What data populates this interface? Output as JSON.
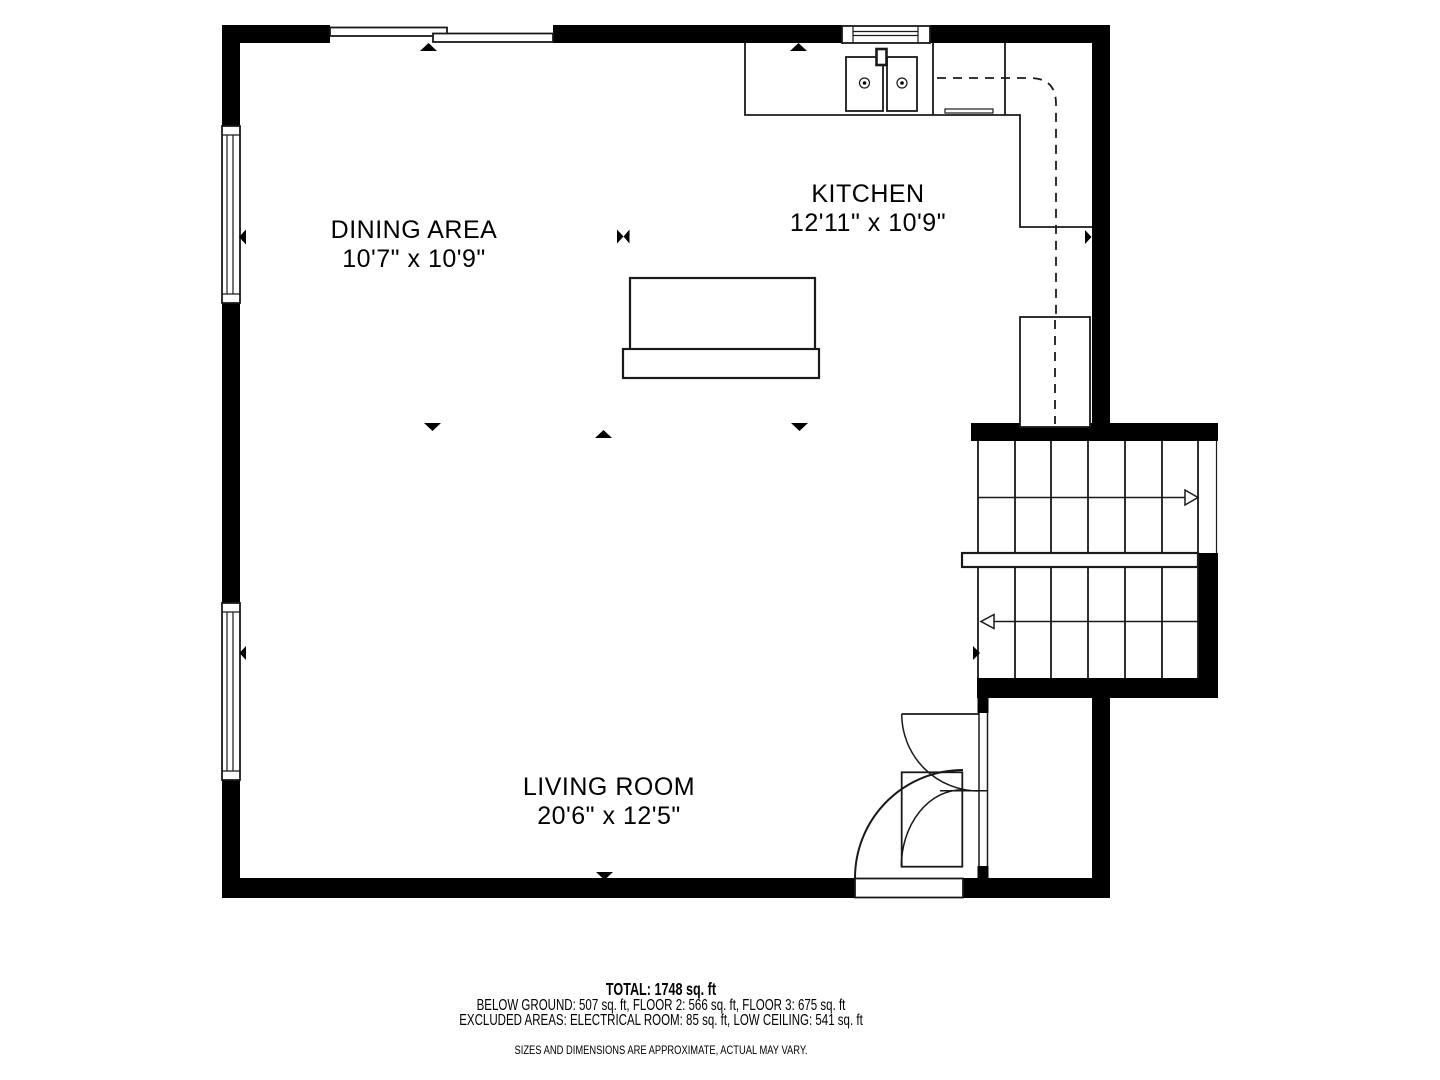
{
  "rooms": [
    {
      "name": "DINING AREA",
      "dims": "10'7\" x 10'9\""
    },
    {
      "name": "KITCHEN",
      "dims": "12'11\" x 10'9\""
    },
    {
      "name": "LIVING ROOM",
      "dims": "20'6\" x 12'5\""
    }
  ],
  "footer": {
    "total": "TOTAL: 1748 sq. ft",
    "areas": "BELOW GROUND: 507 sq. ft, FLOOR 2: 566 sq. ft, FLOOR 3: 675 sq. ft",
    "excluded": "EXCLUDED AREAS: ELECTRICAL ROOM: 85 sq. ft, LOW CEILING: 541 sq. ft",
    "disclaimer": "SIZES AND DIMENSIONS ARE APPROXIMATE, ACTUAL MAY VARY."
  },
  "colors": {
    "wall": "#000000",
    "line": "#1a1a1a",
    "background": "#ffffff"
  }
}
